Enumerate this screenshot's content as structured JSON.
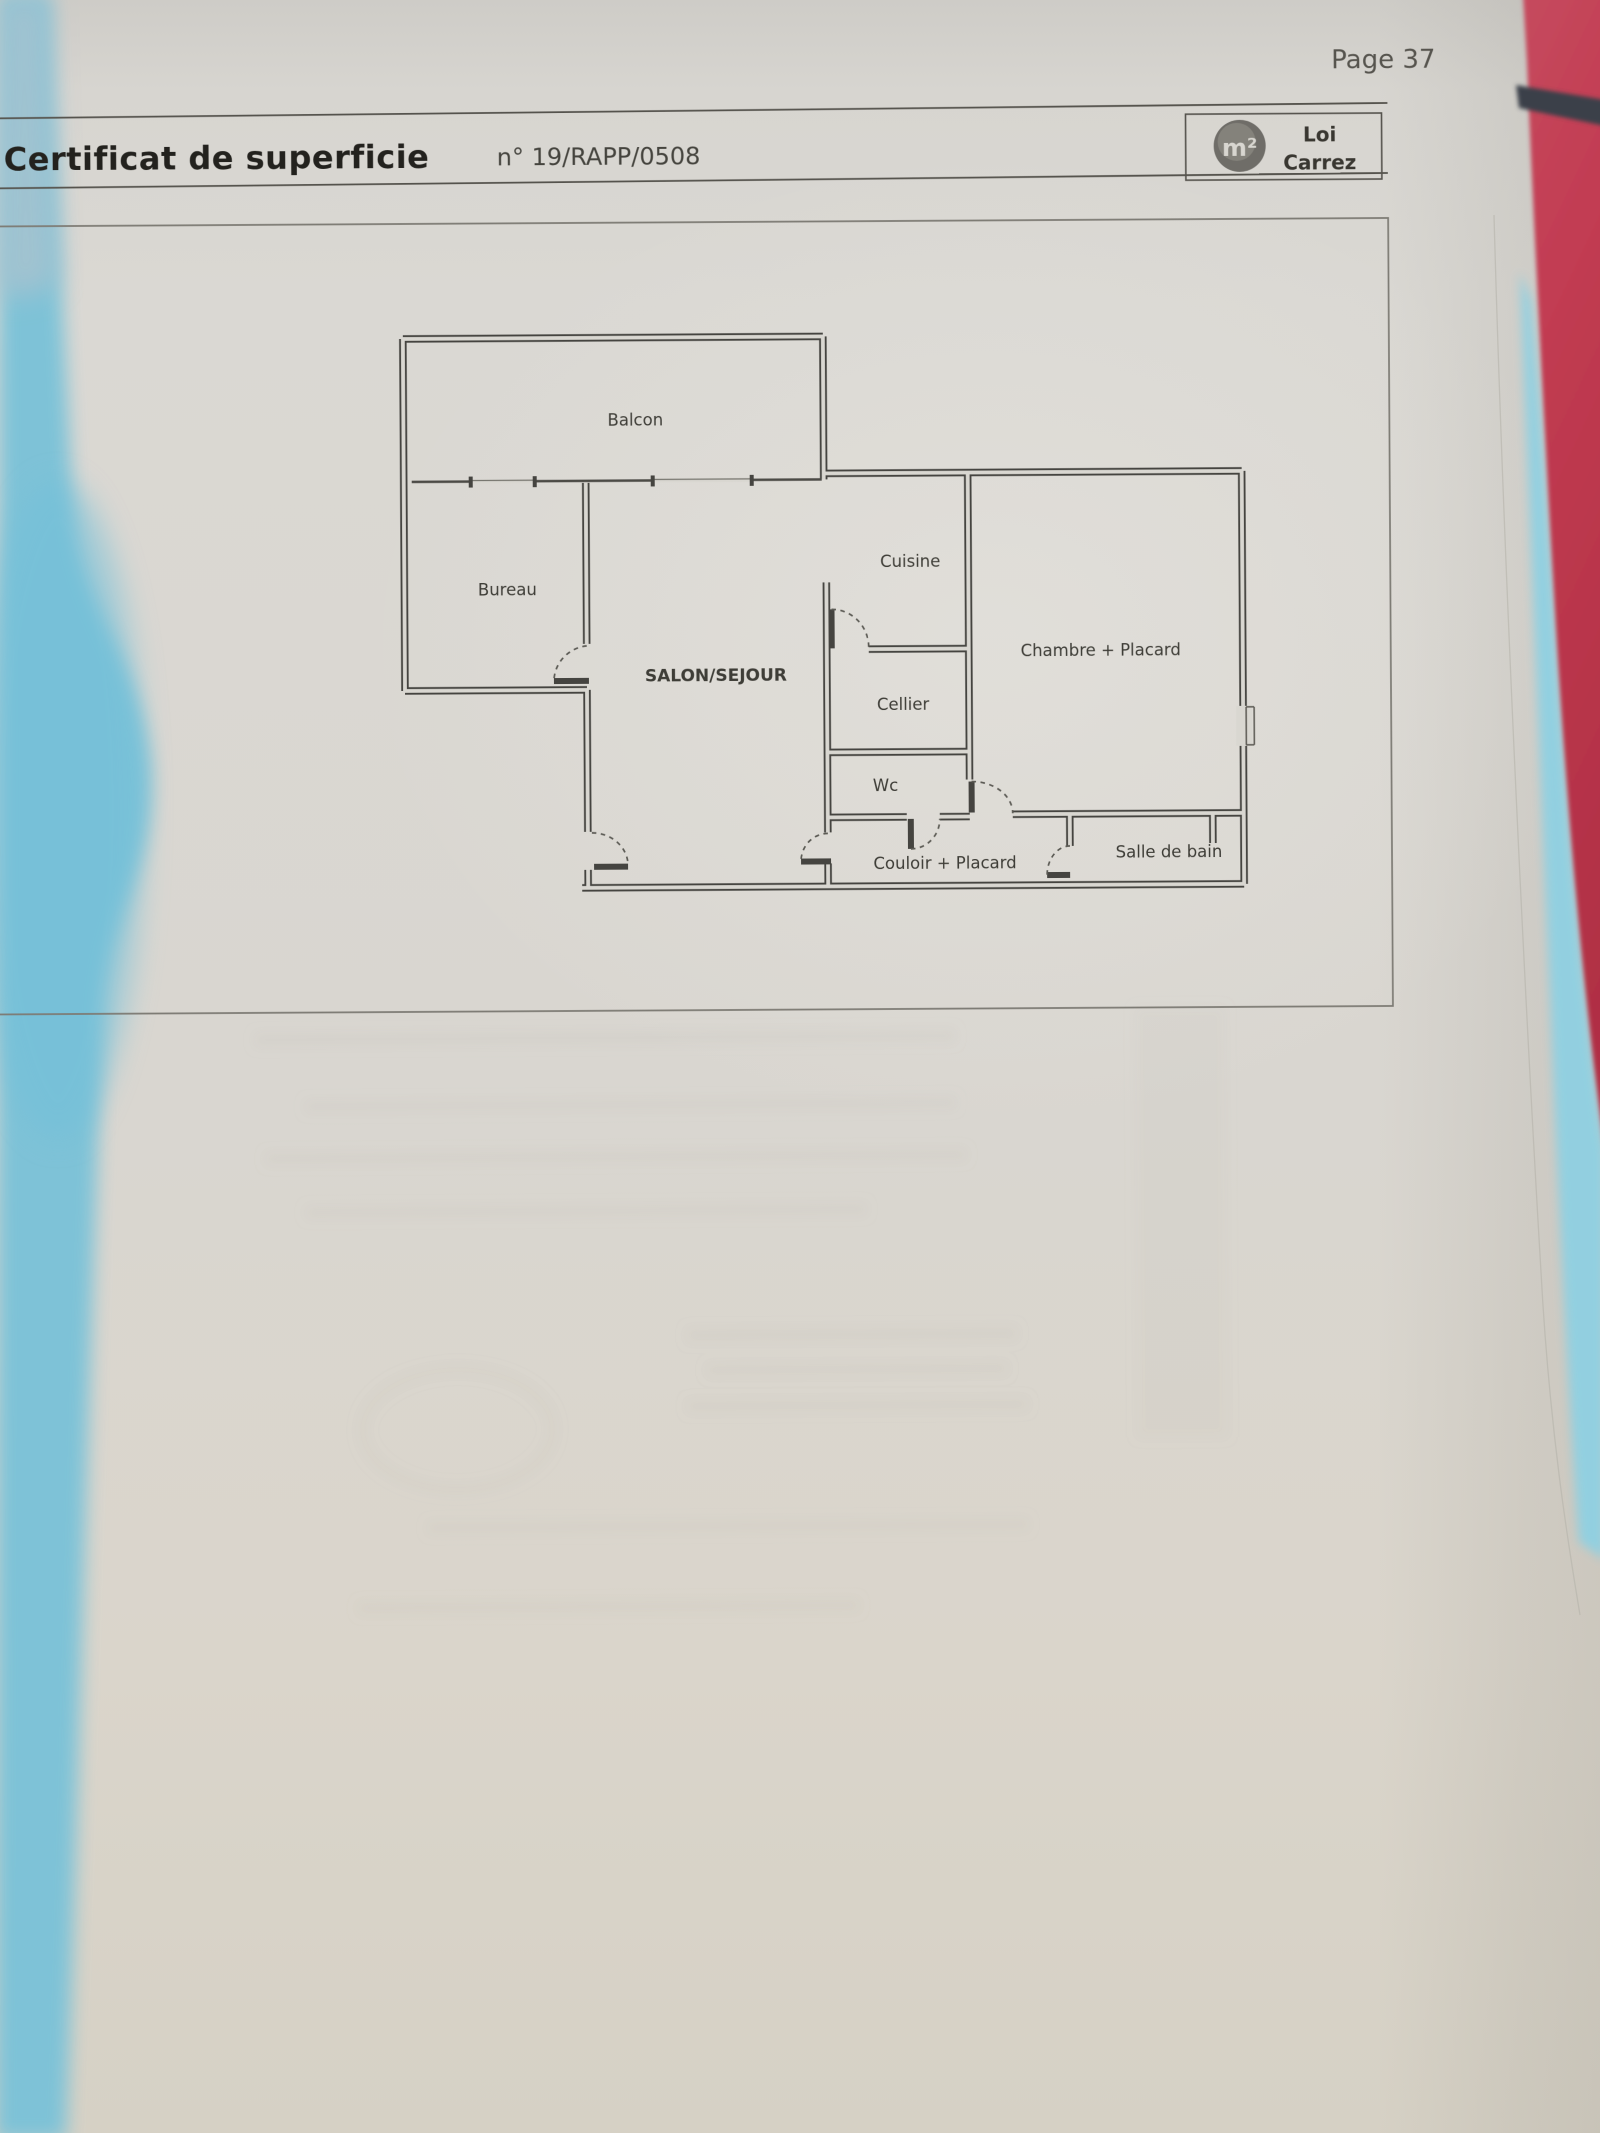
{
  "page_label": "Page 37",
  "header": {
    "title": "Certificat de superficie",
    "doc_number": "n° 19/RAPP/0508"
  },
  "badge": {
    "logo_glyph": "m²",
    "line1": "Loi",
    "line2": "Carrez"
  },
  "floor_plan": {
    "rooms": [
      {
        "id": "balcon",
        "label": "Balcon"
      },
      {
        "id": "bureau",
        "label": "Bureau"
      },
      {
        "id": "salon",
        "label": "SALON/SEJOUR"
      },
      {
        "id": "cuisine",
        "label": "Cuisine"
      },
      {
        "id": "cellier",
        "label": "Cellier"
      },
      {
        "id": "wc",
        "label": "Wc"
      },
      {
        "id": "chambre",
        "label": "Chambre + Placard"
      },
      {
        "id": "couloir",
        "label": "Couloir + Placard"
      },
      {
        "id": "salle_de_bain",
        "label": "Salle de bain"
      }
    ]
  },
  "colors": {
    "paper": "#d9d6d0",
    "ink": "#454440",
    "desk_left_cyan": "#7cc2d8",
    "desk_right_red": "#bf3750",
    "strap_dark": "#3a404a"
  }
}
